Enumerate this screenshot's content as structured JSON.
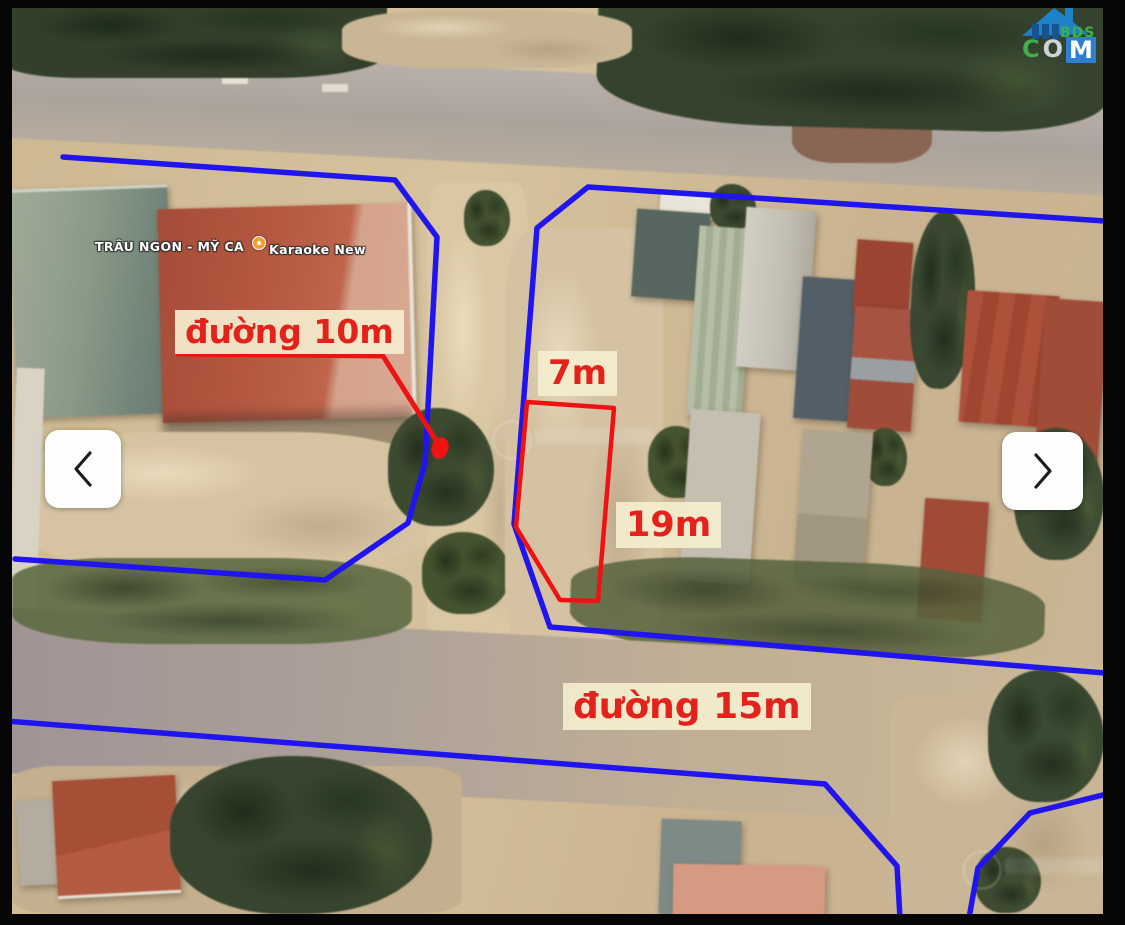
{
  "annotations": {
    "road10_label": "đường 10m",
    "road15_label": "đường 15m",
    "width_label": "7m",
    "depth_label": "19m"
  },
  "poi": {
    "restaurant": "TRÂU NGON - MỸ CA",
    "karaoke": "Karaoke New"
  },
  "logo": {
    "bds": "BDS",
    "c": "C",
    "o": "O",
    "m": "M"
  },
  "colors": {
    "boundary": "#2014ef",
    "plot": "#ee1212",
    "label_bg": "rgba(244,238,206,0.92)",
    "label_text": "#e3231b"
  }
}
